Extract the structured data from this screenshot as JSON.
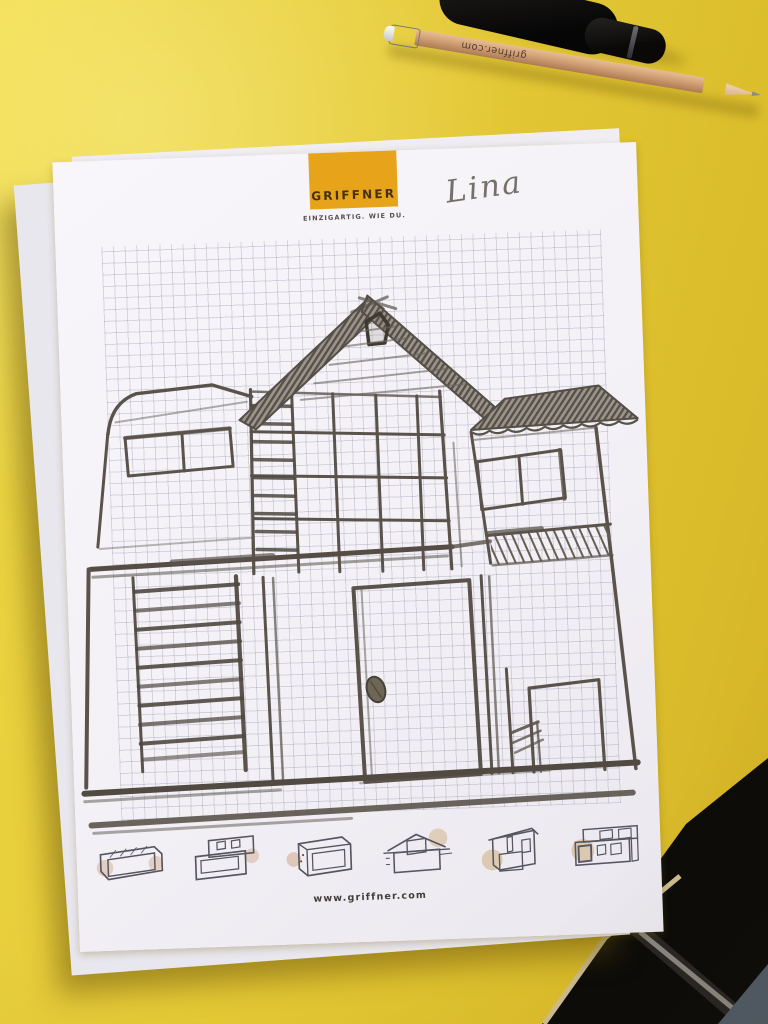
{
  "paper": {
    "brand": "GRIFFNER",
    "tagline": "EINZIGARTIG. WIE DU.",
    "website": "www.griffner.com",
    "student_name": "Lina"
  },
  "pencil": {
    "imprint": "griffner.com"
  },
  "colors": {
    "table_yellow": "#e3c734",
    "logo_orange": "#e7a41a",
    "paper_white": "#f3f1f6",
    "pencil_wood": "#d2a077",
    "sketch_graphite": "#5a534b",
    "dark_floor": "#0c0b09"
  },
  "icons": {
    "house_thumbnails": [
      "flat-roof-bungalow",
      "stacked-flat-roof-house",
      "cube-house",
      "gable-roof-house",
      "mono-pitch-house",
      "modular-flat-roof-house"
    ]
  }
}
